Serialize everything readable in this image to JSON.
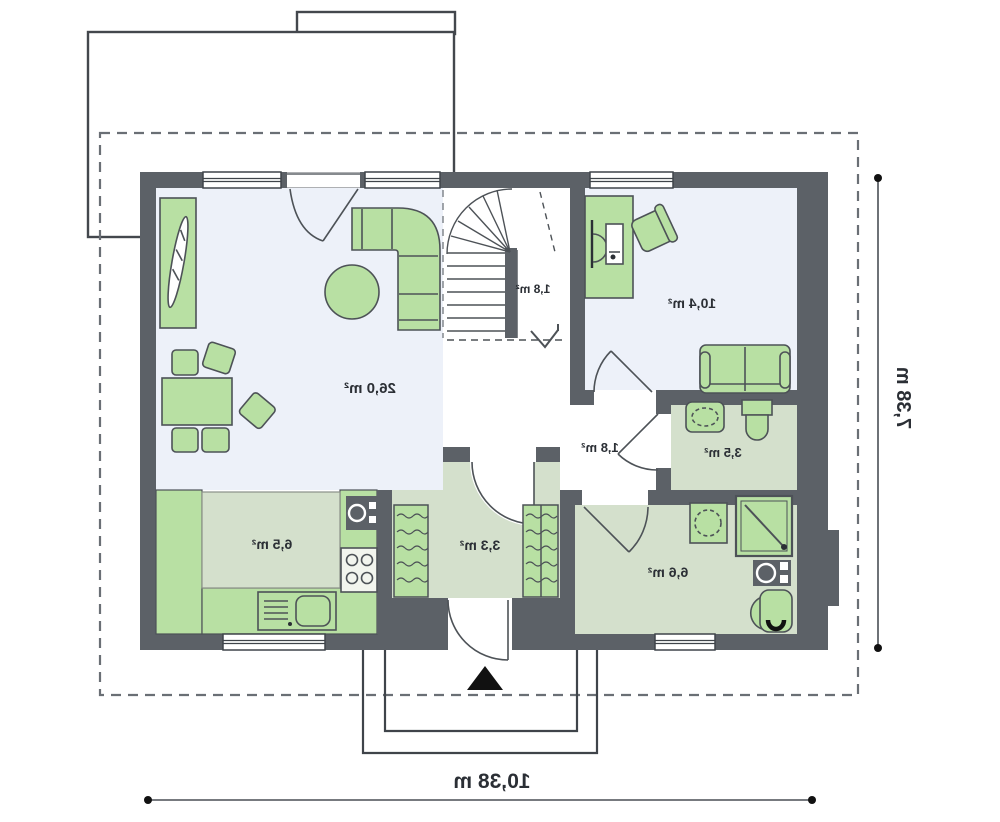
{
  "plan": {
    "type": "floor-plan",
    "rooms": [
      {
        "name": "living-room",
        "area": "26,0 m²"
      },
      {
        "name": "staircase",
        "area": "1,8 m²"
      },
      {
        "name": "bedroom",
        "area": "10,4 m²"
      },
      {
        "name": "hallway",
        "area": "1,8 m²"
      },
      {
        "name": "wc",
        "area": "3,5 m²"
      },
      {
        "name": "kitchen",
        "area": "6,5 m²"
      },
      {
        "name": "entry-hall",
        "area": "3,3 m²"
      },
      {
        "name": "bathroom",
        "area": "6,6 m²"
      }
    ],
    "dimensions": {
      "total_width": "10,38 m",
      "total_height": "7,38 m"
    },
    "colors": {
      "wall": "#5c6167",
      "floor_blue": "#edf1f9",
      "floor_green": "#d4e0cc",
      "furniture_green": "#b8e0a3",
      "outline": "#3f444a"
    }
  }
}
